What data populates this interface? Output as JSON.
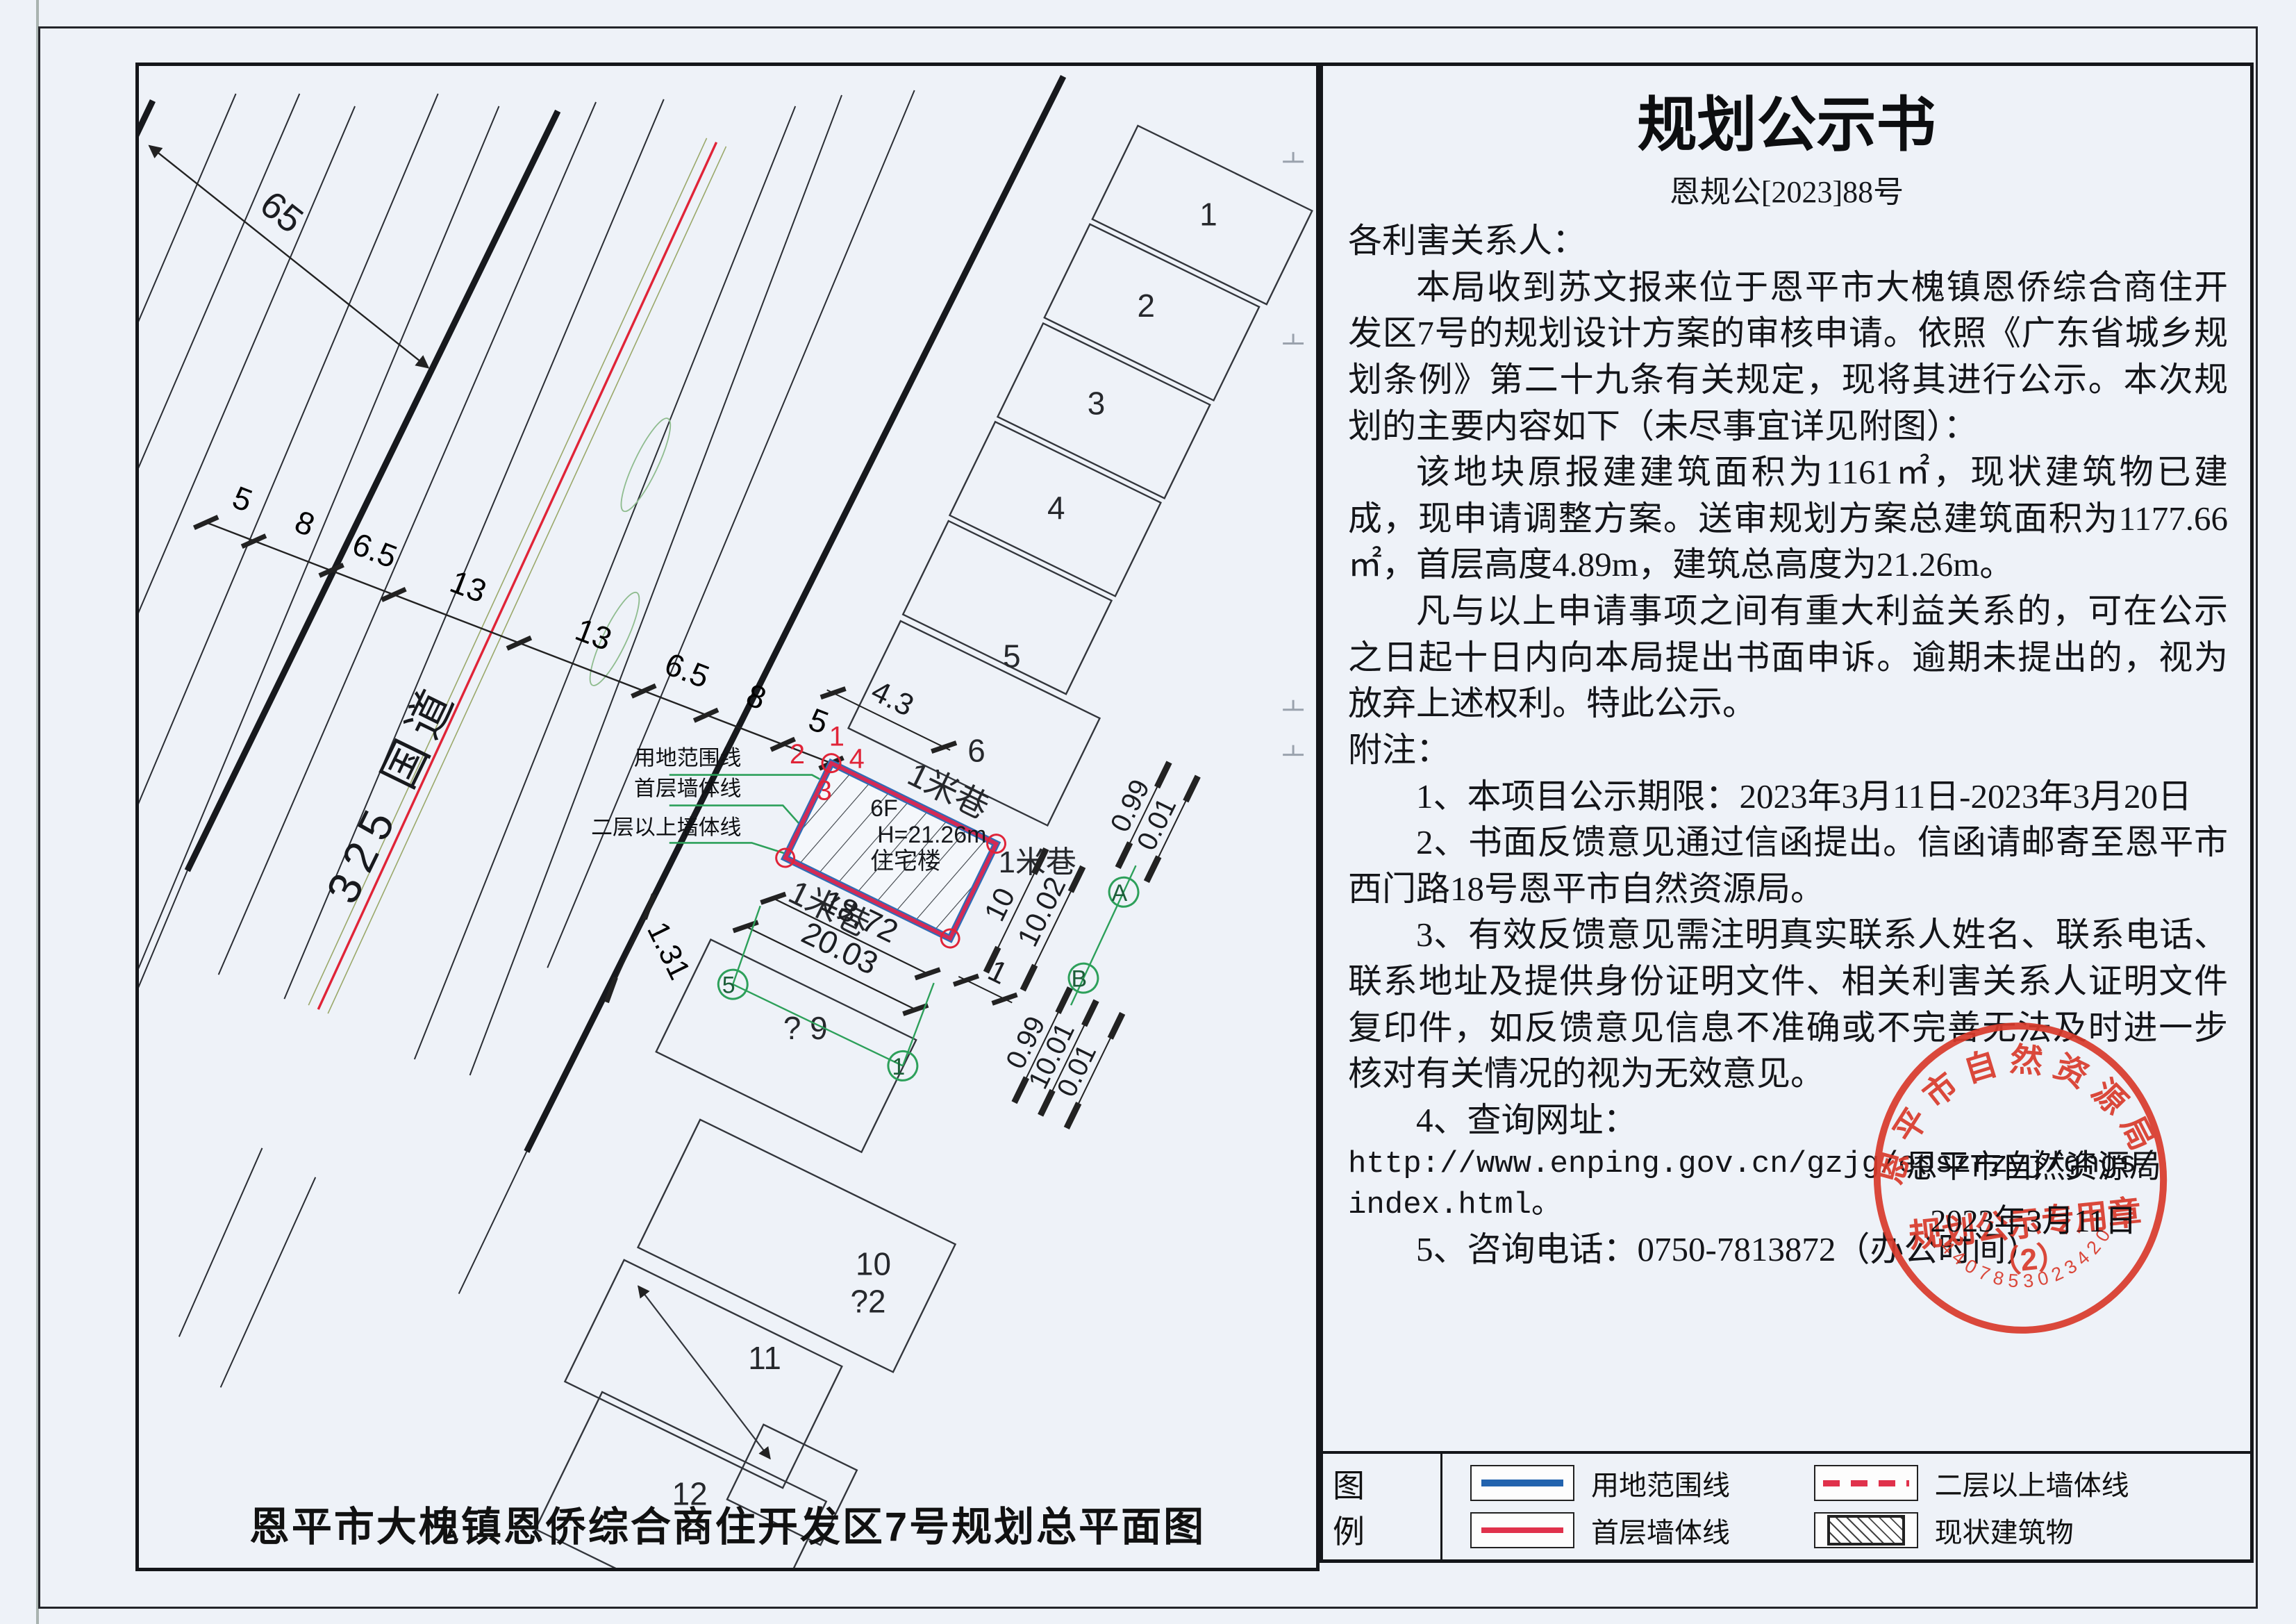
{
  "announcement": {
    "title": "规划公示书",
    "doc_number": "恩规公[2023]88号",
    "salutation": "各利害关系人：",
    "paragraphs": [
      "本局收到苏文报来位于恩平市大槐镇恩侨综合商住开发区7号的规划设计方案的审核申请。依照《广东省城乡规划条例》第二十九条有关规定，现将其进行公示。本次规划的主要内容如下（未尽事宜详见附图）：",
      "该地块原报建建筑面积为1161㎡，现状建筑物已建成，现申请调整方案。送审规划方案总建筑面积为1177.66㎡，首层高度4.89m，建筑总高度为21.26m。",
      "凡与以上申请事项之间有重大利益关系的，可在公示之日起十日内向本局提出书面申诉。逾期未提出的，视为放弃上述权利。特此公示。"
    ],
    "notes_label": "附注：",
    "notes": [
      "1、本项目公示期限：2023年3月11日-2023年3月20日",
      "2、书面反馈意见通过信函提出。信函请邮寄至恩平市西门路18号恩平市自然资源局。",
      "3、有效反馈意见需注明真实联系人姓名、联系电话、联系地址及提供身份证明文件、相关利害关系人证明文件复印件，如反馈意见信息不准确或不完善无法及时进一步核对有关情况的视为无效意见。",
      "4、查询网址："
    ],
    "url_line1": "http://www.enping.gov.cn/gzjg/epszrzyj/ghgs/",
    "url_line2": "index.html。",
    "note_phone": "5、咨询电话：0750-7813872（办公时间）",
    "signature": {
      "agency": "恩平市自然资源局",
      "date": "2023年3月11日"
    },
    "stamp": {
      "arc_text": "恩平市自然资源局",
      "center_line1": "规划公示专用章",
      "center_line2": "（2）",
      "serial": "4407853023420",
      "color": "#d93a2b"
    }
  },
  "legend": {
    "label": "图 例",
    "items": [
      {
        "name": "用地范围线",
        "style": "blue-solid",
        "color": "#2263ae"
      },
      {
        "name": "二层以上墙体线",
        "style": "red-dashed",
        "color": "#e0314b"
      },
      {
        "name": "首层墙体线",
        "style": "red-solid",
        "color": "#e0314b"
      },
      {
        "name": "现状建筑物",
        "style": "hatched",
        "color": "#444444"
      }
    ]
  },
  "site_plan": {
    "caption": "恩平市大槐镇恩侨综合商住开发区7号规划总平面图",
    "road_label": "325 国道",
    "alley_top": "1米巷",
    "alley_bottom": "1米巷",
    "alley_right": "1米巷",
    "building": {
      "floors": "6F",
      "height": "H=21.26m",
      "use": "住宅楼"
    },
    "corners": [
      "1",
      "2",
      "3",
      "4"
    ],
    "callouts": {
      "boundary": "用地范围线",
      "first_floor": "首层墙体线",
      "upper_floor": "二层以上墙体线"
    },
    "parcels": {
      "p1": "1",
      "p2": "2",
      "p3": "3",
      "p4": "4",
      "p5": "5",
      "p6": "6",
      "p9": "? 9",
      "p10": "10",
      "p10b": "?2",
      "p11": "11",
      "p12": "12"
    },
    "chain": {
      "d1": "5",
      "d2": "8",
      "d3": "6.5",
      "d4": "13",
      "d5": "13",
      "d6": "6.5",
      "d7": "8",
      "d8": "5",
      "total": "65"
    },
    "dims": {
      "d43": "4.3",
      "d1872": "18.72",
      "d2003": "20.03",
      "d131": "1.31",
      "d1": "1",
      "d10": "10",
      "d1002": "10.02",
      "d099a": "0.99",
      "d001a": "0.01",
      "d099b": "0.99",
      "d1001": "10.01",
      "d001b": "0.01"
    },
    "points": {
      "a": "A",
      "b": "B",
      "n1": "1",
      "n5": "5"
    },
    "colors": {
      "plot_red": "#d42a55",
      "plot_blue": "#2f6cb5",
      "green": "#2da05a",
      "road_red": "#e02438"
    }
  }
}
